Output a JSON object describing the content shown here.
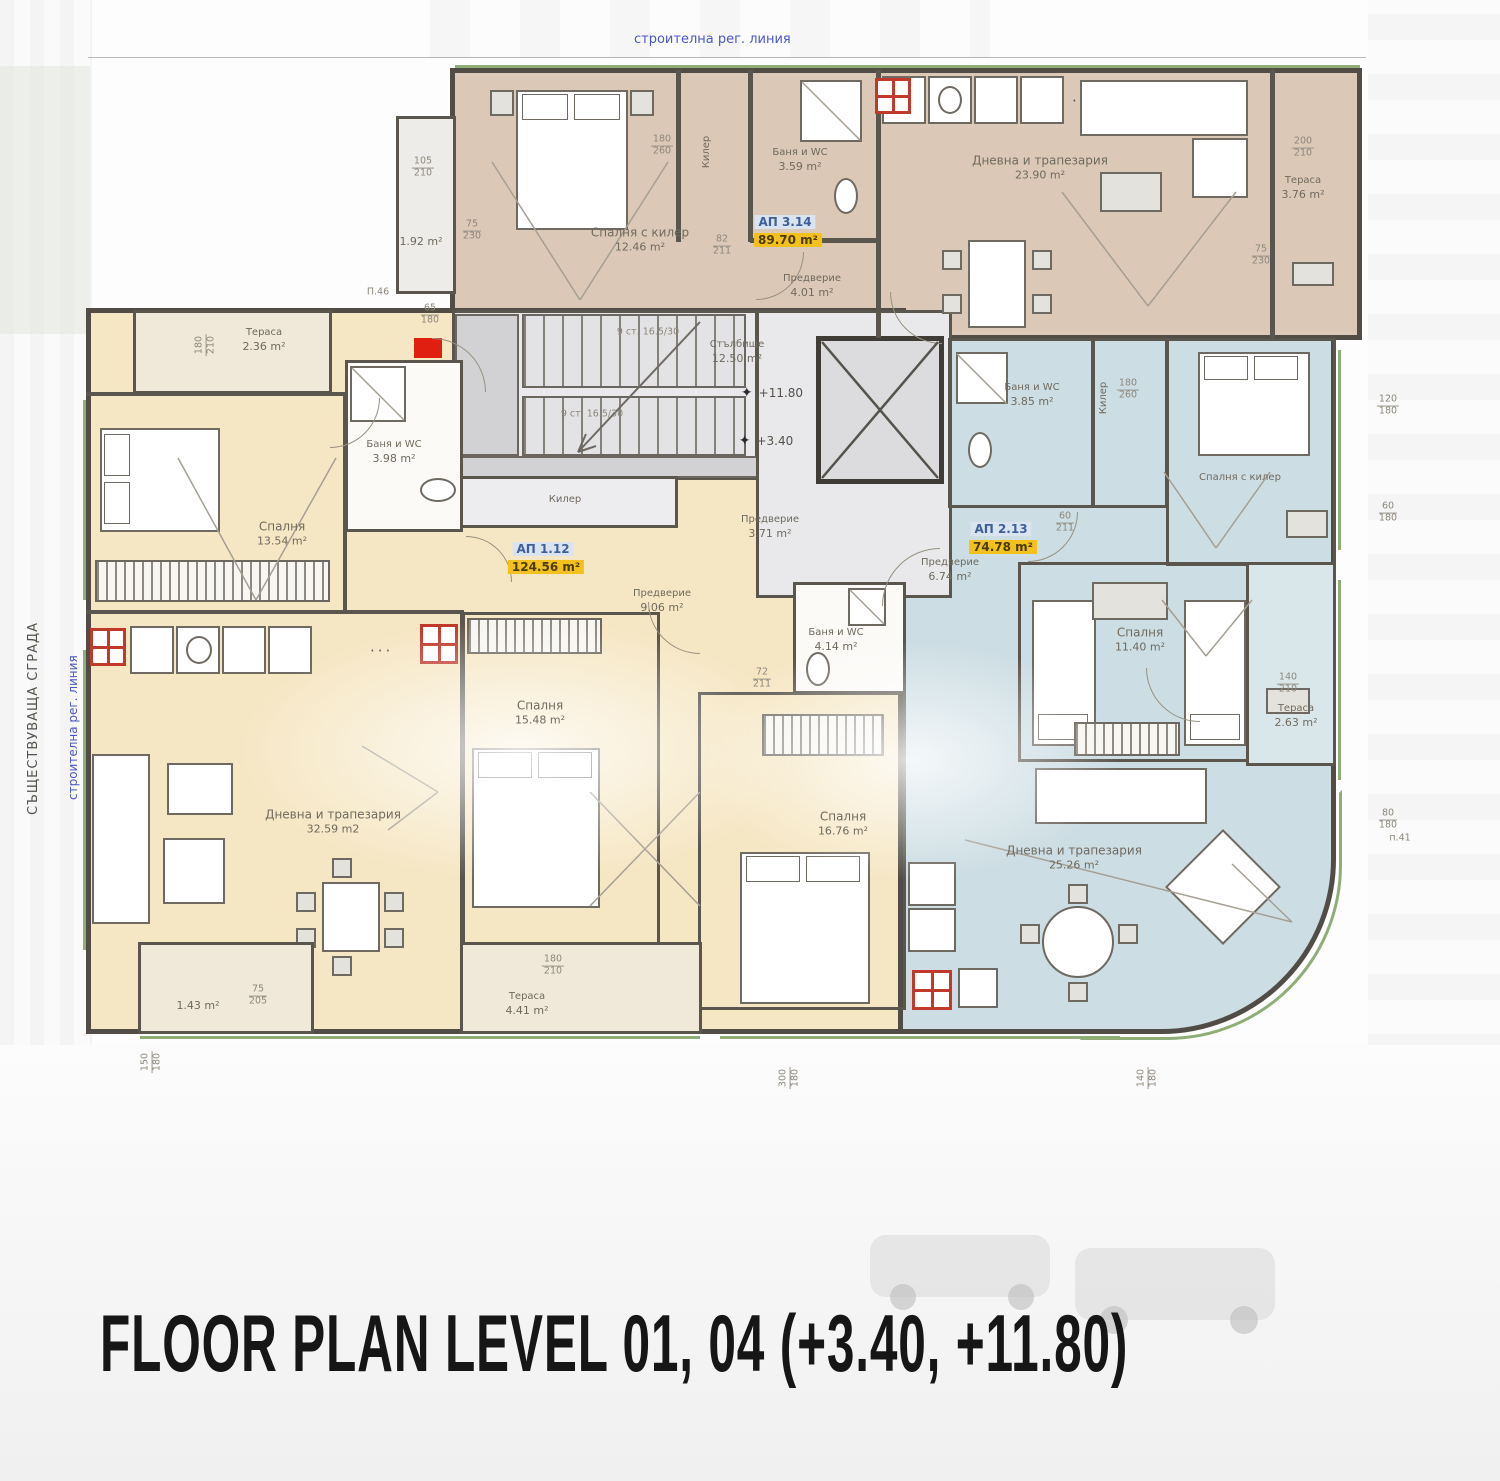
{
  "page": {
    "title": "FLOOR PLAN LEVEL 01, 04 (+3.40, +11.80)"
  },
  "annotations": {
    "top_line": "строителна рег. линия",
    "left_line": "строителна рег. линия",
    "existing_building": "СЪЩЕСТВУВАЩА СГРАДА",
    "stair_note": "9 ст. 16.5/30",
    "level_marks": [
      "+11.80",
      "+3.40"
    ],
    "marker_top_left": "П.46",
    "marker_right": "п.41"
  },
  "icons": {
    "level_star": "✦",
    "kitchen_dots": "···"
  },
  "common": {
    "stairwell": {
      "name": "Стълбище",
      "area": "12.50 m²"
    },
    "lobby": {
      "name": "Предверие",
      "area": "3.71 m²"
    },
    "closet": "Килер"
  },
  "apartments": [
    {
      "id": "АП 3.14",
      "total_area": "89.70 m²",
      "rooms": [
        {
          "name": "Спалня с килер",
          "area": "12.46 m²"
        },
        {
          "name": "Баня и WC",
          "area": "3.59 m²"
        },
        {
          "name": "Предверие",
          "area": "4.01 m²"
        },
        {
          "name": "Дневна и трапезария",
          "area": "23.90 m²"
        },
        {
          "name": "Тераса",
          "area": "3.76 m²"
        },
        {
          "name": "",
          "area": "1.92 m²"
        },
        {
          "name": "Килер",
          "area": ""
        }
      ]
    },
    {
      "id": "АП 1.12",
      "total_area": "124.56 m²",
      "rooms": [
        {
          "name": "Тераса",
          "area": "2.36 m²"
        },
        {
          "name": "Спалня",
          "area": "13.54 m²"
        },
        {
          "name": "Баня и WC",
          "area": "3.98 m²"
        },
        {
          "name": "Предверие",
          "area": "9.06 m²"
        },
        {
          "name": "Дневна и трапезария",
          "area": "32.59 m2"
        },
        {
          "name": "Спалня",
          "area": "15.48 m²"
        },
        {
          "name": "Спалня",
          "area": "16.76 m²"
        },
        {
          "name": "Баня и WC",
          "area": "4.14 m²"
        },
        {
          "name": "Тераса",
          "area": "4.41 m²"
        },
        {
          "name": "",
          "area": "1.43 m²"
        },
        {
          "name": "Килер",
          "area": ""
        }
      ]
    },
    {
      "id": "АП 2.13",
      "total_area": "74.78 m²",
      "rooms": [
        {
          "name": "Баня и WC",
          "area": "3.85 m²"
        },
        {
          "name": "Килер",
          "area": ""
        },
        {
          "name": "Спалня с килер",
          "area": ""
        },
        {
          "name": "Предверие",
          "area": "6.74 m²"
        },
        {
          "name": "Спалня",
          "area": "11.40 m²"
        },
        {
          "name": "Тераса",
          "area": "2.63 m²"
        },
        {
          "name": "Дневна и трапезария",
          "area": "25.26 m²"
        }
      ]
    }
  ],
  "dims": [
    {
      "w": "105",
      "h": "210"
    },
    {
      "w": "75",
      "h": "230"
    },
    {
      "w": "180",
      "h": "260"
    },
    {
      "w": "82",
      "h": "211"
    },
    {
      "w": "200",
      "h": "210"
    },
    {
      "w": "75",
      "h": "230"
    },
    {
      "w": "65",
      "h": "180"
    },
    {
      "w": "180",
      "h": "210"
    },
    {
      "w": "75",
      "h": "205"
    },
    {
      "w": "180",
      "h": "260"
    },
    {
      "w": "60",
      "h": "211"
    },
    {
      "w": "120",
      "h": "180"
    },
    {
      "w": "60",
      "h": "180"
    },
    {
      "w": "140",
      "h": "210"
    },
    {
      "w": "72",
      "h": "211"
    },
    {
      "w": "180",
      "h": "210"
    },
    {
      "w": "300",
      "h": "180"
    },
    {
      "w": "140",
      "h": "180"
    },
    {
      "w": "150",
      "h": "180"
    },
    {
      "w": "80",
      "h": "180"
    }
  ],
  "colors": {
    "apartment_tan": "#dbc8b6",
    "apartment_cream": "#f6e7c4",
    "apartment_blue": "#ccdde3",
    "common_gray": "#e9e9ec",
    "area_highlight": "#f3c11d",
    "apartment_id_bg": "#d9e4f0",
    "regulation_line_text": "#4a57c8",
    "vent_shaft": "#c0392b",
    "entrance_marker": "#e01f10"
  }
}
